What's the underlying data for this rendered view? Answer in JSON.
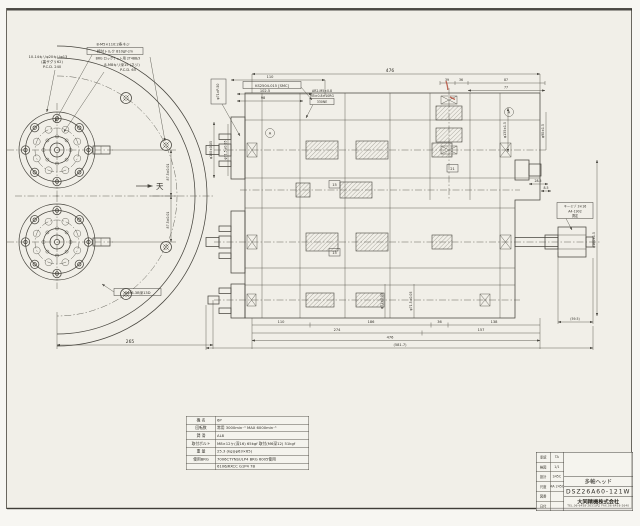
{
  "left_view": {
    "direction_label": "天",
    "note_pcd": {
      "l1": "10-14キリφ20キリφ13",
      "l2": "(裏ザグリ62)",
      "l3": "P.C.D. 240"
    },
    "note_lock": {
      "l1": "8-M5×110:2条ネジ",
      "l2": "締付トルク 810gf-cm",
      "l3": "BRG ロックナット用 2T4BB/3"
    },
    "note_tap": {
      "l1": "8-M8キリ深15 (ネジ)",
      "l2": "P.C.D. 65"
    },
    "note_m6": "4-M6-3B深13D",
    "dim_half_top": "87.5±0.01",
    "dim_half_bottom": "87.5±0.01",
    "dim_width": "265"
  },
  "section_view": {
    "dim_overall_top": "476",
    "dim_110": "110",
    "dim_1025": "102.5",
    "dim_98": "98",
    "label_smc": "KS2504-015 [SMC]",
    "label_boss": "φ71×P-50",
    "note_grease": {
      "l1": "AR2-M5×0.8",
      "l2": "M5×0.8×10RG",
      "l3": "330NE"
    },
    "note_key": {
      "l1": "キーミゾ 3×16",
      "l2": "A4-1902",
      "l3": "測定"
    },
    "dim_39": "39",
    "dim_36": "36",
    "dim_87": "87",
    "dim_77": "77",
    "dim_285": "28.5",
    "dim_85": "8.5",
    "dim_595": "(59.5)",
    "gear_1": "15",
    "gear_2": "21",
    "gear_3": "15",
    "datum_a": "A",
    "datum_b": "A",
    "dim_phi180": "φ180±0.05",
    "dim_phi715": "φ71.5±0.05",
    "dim_phi135": "φ135±1.5",
    "dim_phi90": "φ90±1.5",
    "dim_phi160": "φ160±1.5",
    "dim_phi71a": "φ71±0.05",
    "dim_phi71b": "φ71.5±0.05",
    "dim_b1_110": "110",
    "dim_b1_186": "186",
    "dim_b1_36": "36",
    "dim_b1_138": "138",
    "dim_b2_274": "274",
    "dim_b2_157": "157",
    "dim_b3_476": "476",
    "dim_b4_581": "(581.7)"
  },
  "spec_table": {
    "rows": [
      {
        "label": "機 名",
        "value": "6P"
      },
      {
        "label": "回転数",
        "value": "常用 3000min⁻¹ MAX 6000min⁻¹"
      },
      {
        "label": "潤 滑",
        "value": "AL8"
      },
      {
        "label": "取付ボルト",
        "value": "M8×12ヶ(深16) 65kgf 取付(M6深12) 51kgf"
      },
      {
        "label": "重 量",
        "value": "25.3 (kg)(φ63×65)"
      },
      {
        "label": "使用BRG",
        "value": "7006CTYNSULP4 BRG 6005使用"
      },
      {
        "label": "",
        "value": "6106JRXCC G1P4 7B"
      }
    ]
  },
  "title_block": {
    "left_rows": [
      [
        "承認",
        "TA"
      ],
      [
        "検図",
        "1/1"
      ],
      [
        "設計",
        "S45C"
      ],
      [
        "尺度",
        "MA 245C"
      ],
      [
        "図番",
        ""
      ],
      [
        "日付",
        ""
      ]
    ],
    "product_name": "多軸ヘッド",
    "drawing_number": "DSZ26A60-121W",
    "company": "大同精機株式会社",
    "company_tel": "TEL.06-6458-2631(代) FAX.06-6458-2640"
  }
}
